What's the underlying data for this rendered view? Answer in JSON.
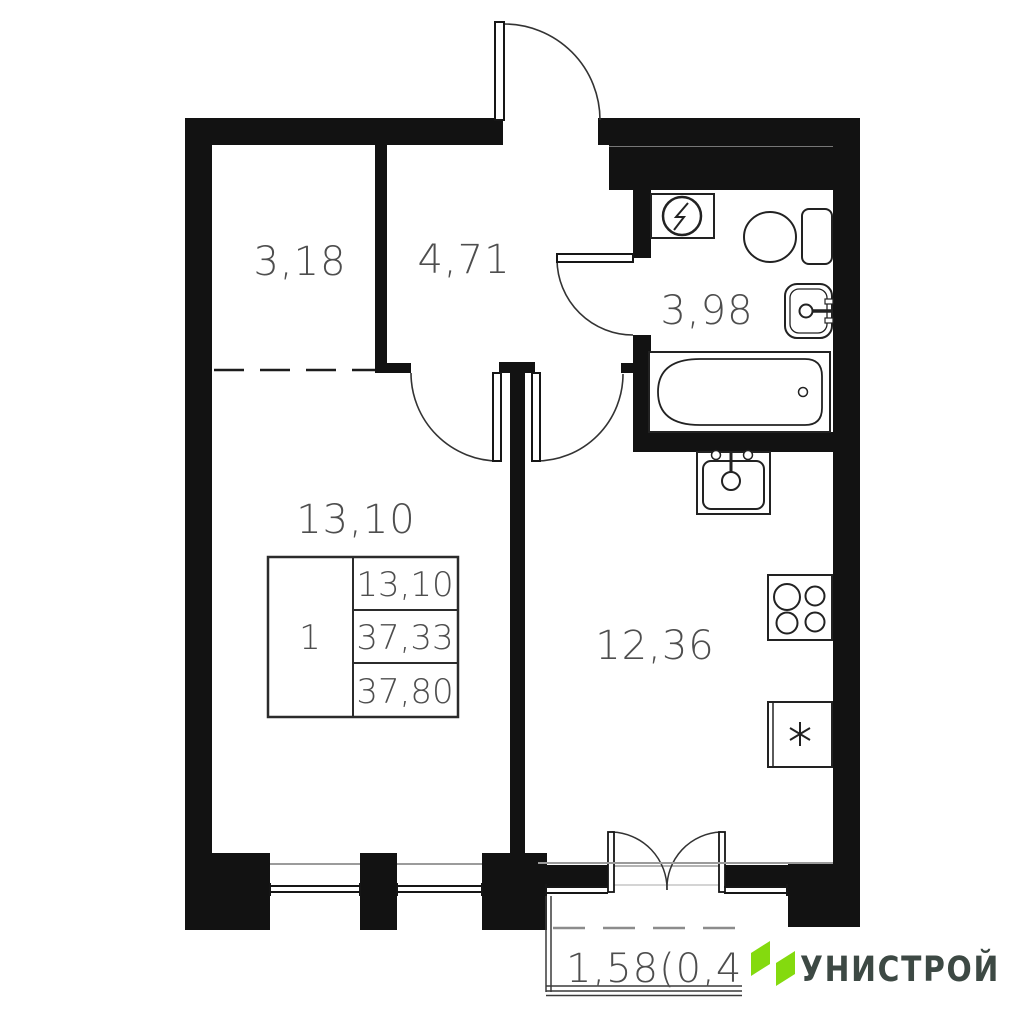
{
  "plan": {
    "rooms": [
      {
        "name": "wardrobe",
        "area": "3,18"
      },
      {
        "name": "hallway",
        "area": "4,71"
      },
      {
        "name": "bathroom",
        "area": "3,98"
      },
      {
        "name": "living-room",
        "area": "13,10"
      },
      {
        "name": "kitchen",
        "area": "12,36"
      },
      {
        "name": "balcony",
        "area": "1,58(0,4"
      }
    ],
    "info_table": {
      "rooms_count": "1",
      "living_area": "13,10",
      "area_without_balcony": "37,33",
      "total_area": "37,80"
    },
    "fixtures": [
      "washing-machine",
      "toilet",
      "washbasin",
      "bathtub",
      "kitchen-sink",
      "stove",
      "fridge"
    ],
    "colors": {
      "wall": "#121212",
      "fixture_line": "#222222",
      "label": "#4e4e4e",
      "dash_gray": "#8c8c8c"
    }
  },
  "logo": {
    "brand": "УНИСТРОЙ",
    "accent_green": "#84da0e",
    "text_color": "#3d4944"
  }
}
